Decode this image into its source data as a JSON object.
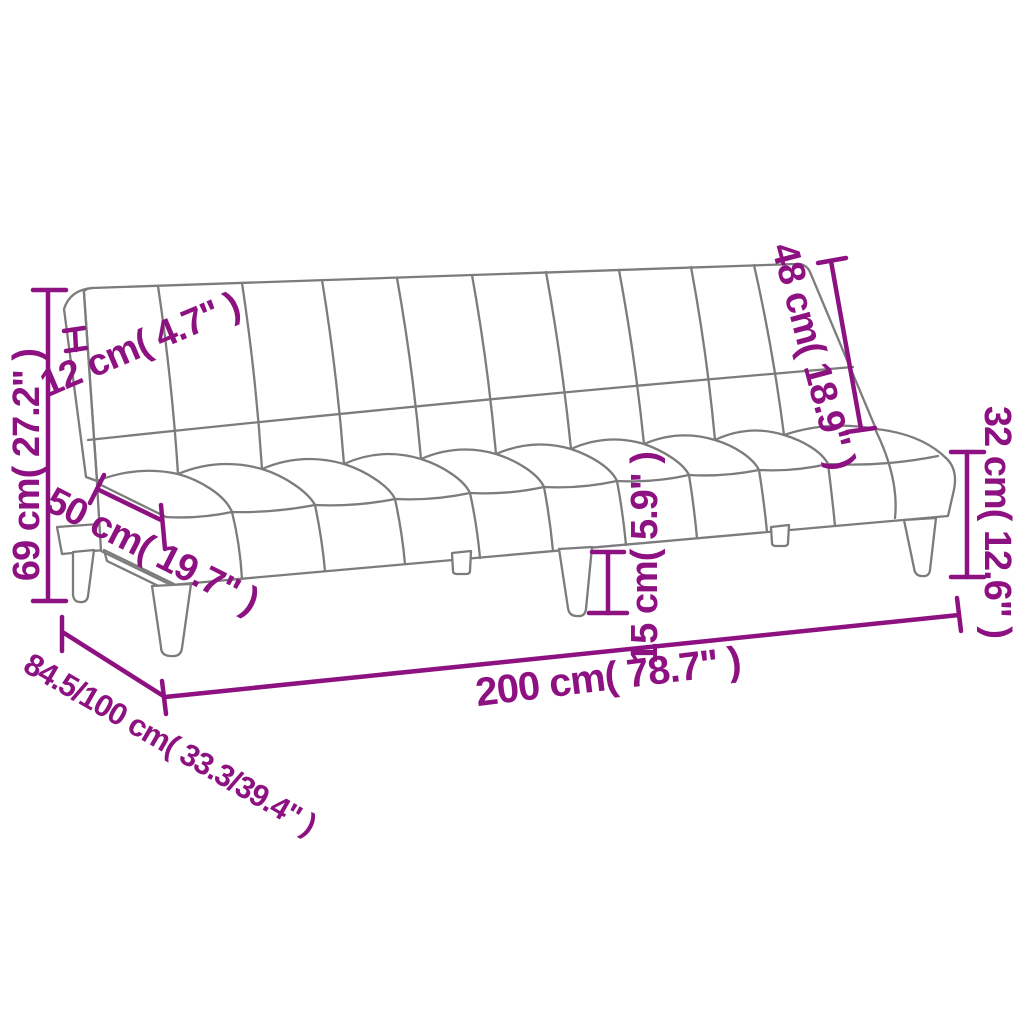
{
  "diagram": {
    "type": "product-dimension-diagram",
    "subject": "sofa-bed line drawing with measurement annotations",
    "colors": {
      "dimension_accent": "#8E1182",
      "outline_gray": "#7C7C7C",
      "background": "#FFFFFF"
    },
    "dimensions": {
      "overall_height": "69 cm( 27.2\" )",
      "backrest_thickness": "12 cm( 4.7\" )",
      "seat_depth": "50 cm( 19.7\" )",
      "depth_sofa_bed": "84.5/100 cm( 33.3/39.4\" )",
      "overall_width": "200 cm( 78.7\" )",
      "leg_height": "15 cm( 5.9\" )",
      "backrest_height": "48 cm( 18.9\" )",
      "seat_height": "32 cm( 12.6\" )"
    }
  }
}
